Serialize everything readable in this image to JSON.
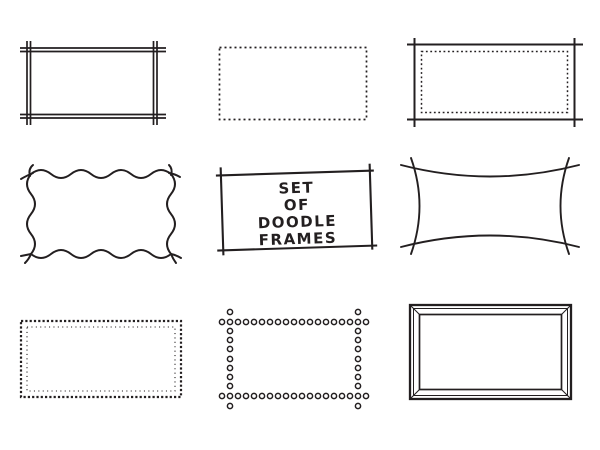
{
  "canvas": {
    "background": "#ffffff",
    "ink": "#231f20"
  },
  "title_frame_text": {
    "line1": "SET",
    "line2": "OF",
    "line3": "DOODLE",
    "line4": "FRAMES"
  },
  "frames": [
    {
      "id": "double-line-crossed-frame",
      "name": "double line frame with crossed corners",
      "row": 1,
      "col": 1
    },
    {
      "id": "dashed-frame",
      "name": "dashed rectangle frame",
      "row": 1,
      "col": 2
    },
    {
      "id": "crossed-frame-dotted-inner",
      "name": "crossed corner frame with dotted inner border",
      "row": 1,
      "col": 3
    },
    {
      "id": "wavy-frame",
      "name": "wavy squiggle frame with crossed corners",
      "row": 2,
      "col": 1
    },
    {
      "id": "title-frame",
      "name": "hand drawn title frame",
      "row": 2,
      "col": 2
    },
    {
      "id": "concave-frame",
      "name": "concave curved frame with crossed corners",
      "row": 2,
      "col": 3
    },
    {
      "id": "double-dotted-frame",
      "name": "double dotted rectangle frame",
      "row": 3,
      "col": 1
    },
    {
      "id": "circle-dot-frame",
      "name": "open circle frame with extended rows",
      "row": 3,
      "col": 2
    },
    {
      "id": "picture-frame",
      "name": "mitered picture frame",
      "row": 3,
      "col": 3
    }
  ]
}
